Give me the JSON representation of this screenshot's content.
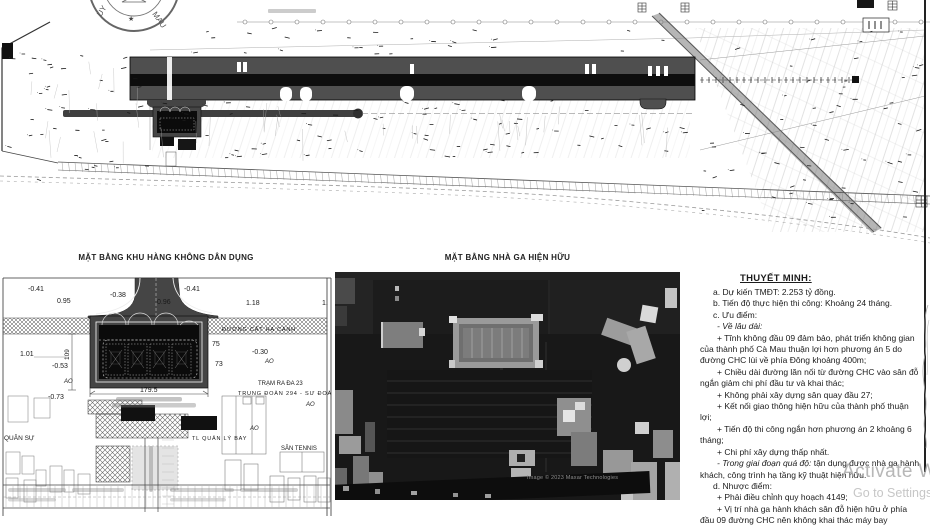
{
  "site_plan": {
    "seal": {
      "left": "UY",
      "star": "★",
      "right": "MAU"
    }
  },
  "civil_plan": {
    "title": "MẶT BẰNG KHU HÀNG KHÔNG DÂN DỤNG",
    "labels": [
      {
        "t": "-0.41",
        "x": 28,
        "y": 291,
        "s": 7
      },
      {
        "t": "0.95",
        "x": 57,
        "y": 303,
        "s": 7
      },
      {
        "t": "-0.38",
        "x": 110,
        "y": 297,
        "s": 7
      },
      {
        "t": "0.96",
        "x": 157,
        "y": 304,
        "s": 7
      },
      {
        "t": "-0.41",
        "x": 184,
        "y": 291,
        "s": 7
      },
      {
        "t": "1.18",
        "x": 246,
        "y": 305,
        "s": 7
      },
      {
        "t": "1.",
        "x": 322,
        "y": 305,
        "s": 7
      },
      {
        "t": "ĐƯỜNG CẤT HẠ CÁNH",
        "x": 222,
        "y": 331,
        "s": 5.5
      },
      {
        "t": "1.01",
        "x": 20,
        "y": 356,
        "s": 7
      },
      {
        "t": "109",
        "x": 69,
        "y": 360,
        "s": 6.5,
        "r": -90
      },
      {
        "t": "-0.53",
        "x": 52,
        "y": 368,
        "s": 7
      },
      {
        "t": "AO",
        "x": 64,
        "y": 383,
        "s": 6,
        "i": true
      },
      {
        "t": "75",
        "x": 212,
        "y": 346,
        "s": 7
      },
      {
        "t": "-0.30",
        "x": 252,
        "y": 354,
        "s": 7
      },
      {
        "t": "AO",
        "x": 265,
        "y": 363,
        "s": 6,
        "i": true
      },
      {
        "t": "73",
        "x": 215,
        "y": 366,
        "s": 7
      },
      {
        "t": "179.5",
        "x": 140,
        "y": 392,
        "s": 7
      },
      {
        "t": "-0.73",
        "x": 48,
        "y": 399,
        "s": 7
      },
      {
        "t": "TRẠM RA ĐA 23",
        "x": 258,
        "y": 385,
        "s": 6
      },
      {
        "t": "TRUNG ĐOÀN 294 - SƯ ĐOÀN 367",
        "x": 238,
        "y": 395,
        "s": 5.6
      },
      {
        "t": "AO",
        "x": 306,
        "y": 406,
        "s": 6,
        "i": true
      },
      {
        "t": "AO",
        "x": 250,
        "y": 430,
        "s": 6,
        "i": true
      },
      {
        "t": "QUÂN SỰ",
        "x": 4,
        "y": 440,
        "s": 6.5
      },
      {
        "t": "TL QUẢN LÝ BAY",
        "x": 192,
        "y": 440,
        "s": 5.5
      },
      {
        "t": "SÂN TENNIS",
        "x": 281,
        "y": 450,
        "s": 6
      }
    ]
  },
  "terminal_photo": {
    "title": "MẶT BẰNG NHÀ GA HIỆN HỮU",
    "watermark": "Image © 2023 Maxar Technologies"
  },
  "notes": {
    "title": "THUYẾT MINH:",
    "paragraphs": [
      {
        "t": "a. Dự kiến TMĐT: 2.253 tỷ đồng."
      },
      {
        "t": "b. Tiến độ thực hiện thi công: Khoảng 24 tháng."
      },
      {
        "t": "c. Ưu điểm:"
      },
      {
        "i": "- Về lâu dài:",
        "t": ""
      },
      {
        "t": "+ Tĩnh không đầu 09 đảm bảo, phát triển không gian của thành phố Cà Mau thuận lợi hơn phương án 5 do đường CHC lùi về phía Đông khoảng 400m;"
      },
      {
        "t": "+ Chiều dài đường lăn nối từ đường CHC vào sân đỗ ngắn giảm chi phí đầu tư và khai thác;"
      },
      {
        "t": "+ Không phải xây dựng sân quay đầu 27;"
      },
      {
        "t": "+ Kết nối giao thông hiện hữu của thành phố thuận lợi;"
      },
      {
        "t": "+ Tiến độ thi công ngắn hơn phương án 2 khoảng 6 tháng;"
      },
      {
        "t": "+ Chi phí xây dựng thấp nhất."
      },
      {
        "i": "- Trong giai đoạn quá độ:",
        "t": " tận dụng được nhà ga hành khách, công trình hạ tầng kỹ thuật  hiện hữu."
      },
      {
        "t": "d. Nhược điểm:"
      },
      {
        "t": "+ Phải điều chỉnh quy hoạch 4149;"
      },
      {
        "t": "+ Vị trí nhà ga hành khách sân đỗ hiện hữu ở phía đầu 09 đường CHC nên không khai thác máy bay"
      }
    ]
  },
  "system_watermark": {
    "line1": "Activate W",
    "line2": "Go to Settings"
  }
}
